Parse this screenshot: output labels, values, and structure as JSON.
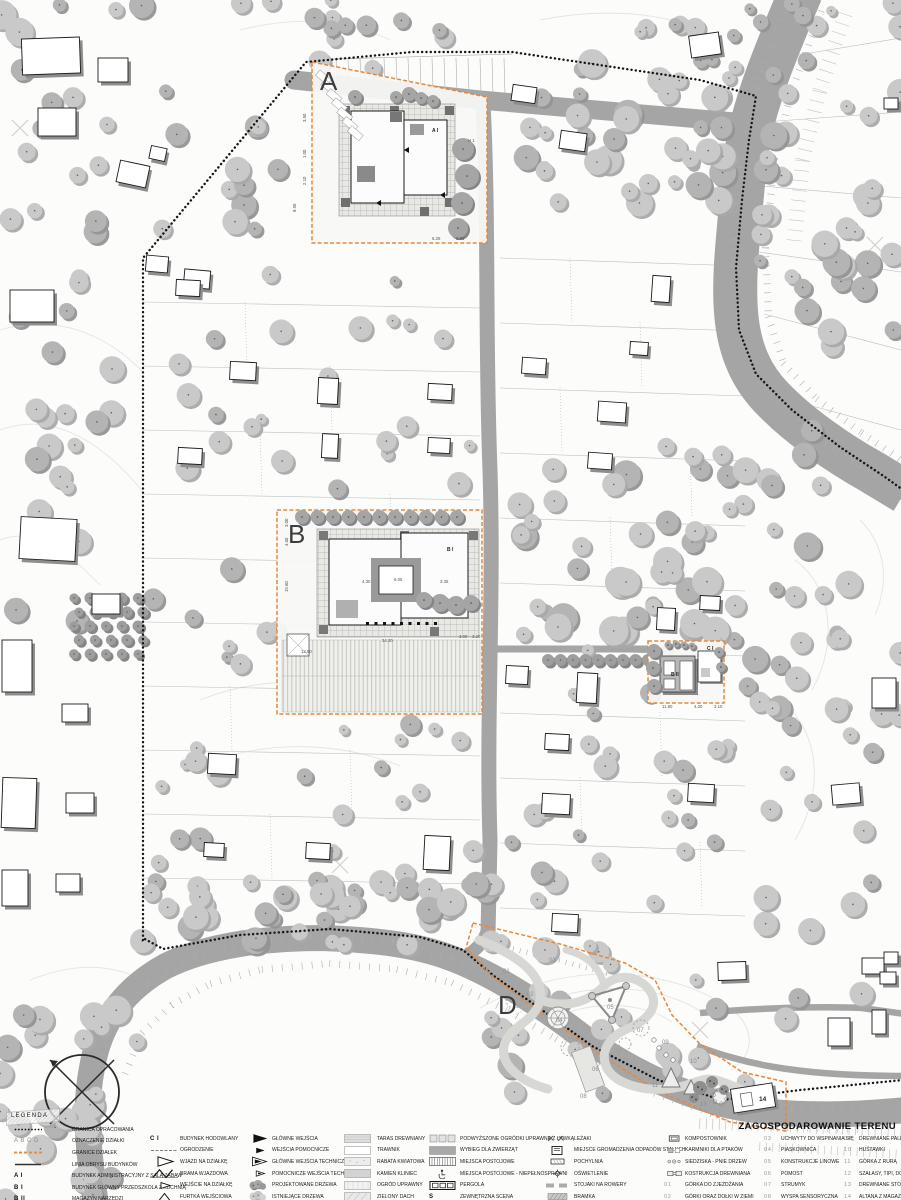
{
  "legend": {
    "title": "ZAGOSPODAROWANIE TERENU",
    "heading": "LEGENDA",
    "columns": [
      {
        "items": [
          {
            "sym": "dots",
            "label": "GRANICA OPRACOWANIA"
          },
          {
            "sym": "key-gray",
            "key": "A B C D",
            "label": "OZNACZENIE DZIAŁKI"
          },
          {
            "sym": "orange-dash",
            "label": "GRANICE DZIAŁEK"
          },
          {
            "sym": "solid-line",
            "label": "LINIA OBRYSU BUDYNKÓW"
          },
          {
            "sym": "key",
            "key": "A I",
            "label": "BUDYNEK ADMINISTRACYJNY Z SALĄ ZABAW"
          },
          {
            "sym": "key",
            "key": "B I",
            "label": "BUDYNEK GŁÓWNY PRZEDSZKOLA Z KUCHNIĄ"
          },
          {
            "sym": "key",
            "key": "B II",
            "label": "MAGAZYN NARZĘDZI"
          }
        ]
      },
      {
        "items": [
          {
            "sym": "key",
            "key": "C I",
            "label": "BUDYNEK HODOWLANY"
          },
          {
            "sym": "fence",
            "label": "OGRODZENIE"
          },
          {
            "sym": "tri-open-lg",
            "label": "WJAZD NA DZIAŁKĘ"
          },
          {
            "sym": "gate",
            "label": "BRAMA WJAZDOWA"
          },
          {
            "sym": "tri-open-sm",
            "label": "WEJŚCIE NA DZIAŁKĘ"
          },
          {
            "sym": "wicket",
            "label": "FURTKA WEJŚCIOWA"
          }
        ]
      },
      {
        "items": [
          {
            "sym": "tri-fill-lg",
            "label": "GŁÓWNE WEJŚCIA"
          },
          {
            "sym": "tri-fill-sm",
            "label": "WEJŚCIA POMOCNICZE"
          },
          {
            "sym": "tri-tech-lg",
            "label": "GŁÓWNE WEJŚCIA TECHNICZNE"
          },
          {
            "sym": "tri-tech-sm",
            "label": "POMOCNICZE WEJŚCIA TECHNICZNE"
          },
          {
            "sym": "tree-dark",
            "label": "PROJEKTOWANE DRZEWA"
          },
          {
            "sym": "tree-light",
            "label": "ISTNIEJĄCE DRZEWA"
          }
        ]
      },
      {
        "items": [
          {
            "sym": "sw-taras",
            "label": "TARAS DREWNIANY"
          },
          {
            "sym": "sw-trawnik",
            "label": "TRAWNIK"
          },
          {
            "sym": "sw-rabata",
            "label": "RABATA KWIATOWA"
          },
          {
            "sym": "sw-kamien",
            "label": "KAMIEŃ KLINIEC"
          },
          {
            "sym": "sw-ogrod",
            "label": "OGRÓD UPRAWNY"
          },
          {
            "sym": "sw-dach",
            "label": "ZIELONY DACH"
          }
        ]
      },
      {
        "items": [
          {
            "sym": "boxes3",
            "label": "PODWYŻSZONE OGRÓDKI UPRAWNE Z ŁAWKĄ"
          },
          {
            "sym": "sw-wybieg",
            "label": "WYBIEG DLA ZWIERZĄT"
          },
          {
            "sym": "stripes",
            "label": "MIEJSCA POSTOJOWE"
          },
          {
            "sym": "disabled",
            "label": "MIEJSCA POSTOJOWE - NIEPEŁNOSPRAWNI"
          },
          {
            "sym": "pergola",
            "label": "PERGOLA"
          },
          {
            "sym": "key",
            "key": "S",
            "label": "ZEWNĘTRZNA SCENA"
          }
        ]
      },
      {
        "items": [
          {
            "sym": "lezaki",
            "label": "LEŻAKI"
          },
          {
            "sym": "odpady",
            "label": "MIEJSCE GROMADZENIA ODPADÓW STAŁYCH"
          },
          {
            "sym": "pochylnia",
            "label": "POCHYLNIA"
          },
          {
            "sym": "oswietlenie",
            "label": "OŚWIETLENIE"
          },
          {
            "sym": "stojaki",
            "label": "STOJAKI NA ROWERY"
          },
          {
            "sym": "bramka",
            "label": "BRAMKA"
          }
        ]
      },
      {
        "items": [
          {
            "sym": "kompost",
            "label": "KOMPOSTOWNIK"
          },
          {
            "sym": "karmniki",
            "label": "KARMNIKI DLA PTAKÓW"
          },
          {
            "sym": "siedziska",
            "label": "SIEDZISKA - PNIE DRZEW"
          },
          {
            "sym": "konstrukcja",
            "label": "KOSTRUKCJA DREWNIANA"
          },
          {
            "sym": "key-num",
            "key": "01",
            "label": "GÓRKA DO ZJEŻDŻANIA"
          },
          {
            "sym": "key-num",
            "key": "02",
            "label": "GÓRKI ORAZ DOŁKI W ZIEMI"
          }
        ]
      },
      {
        "items": [
          {
            "sym": "key-num",
            "key": "03",
            "label": "UCHWYTY DO WSPINANIA SIĘ"
          },
          {
            "sym": "key-num",
            "key": "04",
            "label": "PIASKOWNICA"
          },
          {
            "sym": "key-num",
            "key": "05",
            "label": "KONSTRUKCJE LINOWE"
          },
          {
            "sym": "key-num",
            "key": "06",
            "label": "POMOST"
          },
          {
            "sym": "key-num",
            "key": "07",
            "label": "STRUMYK"
          },
          {
            "sym": "key-num",
            "key": "08",
            "label": "WYSPA SENSORYCZNA"
          }
        ]
      },
      {
        "items": [
          {
            "sym": "key-num",
            "key": "09",
            "label": "DREWNIANE PALE"
          },
          {
            "sym": "key-num",
            "key": "10",
            "label": "HUŚTAWKI"
          },
          {
            "sym": "key-num",
            "key": "11",
            "label": "GÓRKA Z RURĄ"
          },
          {
            "sym": "key-num",
            "key": "12",
            "label": "SZAŁASY, TIPI, DOMKI"
          },
          {
            "sym": "key-num",
            "key": "13",
            "label": "DREWNIANE STOŁECZKI"
          },
          {
            "sym": "key-num",
            "key": "14",
            "label": "ALTANA Z MAGAZYNEM"
          }
        ]
      }
    ]
  },
  "map": {
    "area_labels": [
      {
        "t": "A",
        "x": 320,
        "y": 90
      },
      {
        "t": "B",
        "x": 288,
        "y": 543
      },
      {
        "t": "D",
        "x": 498,
        "y": 1014
      }
    ],
    "building_labels": [
      {
        "t": "A I",
        "x": 432,
        "y": 132
      },
      {
        "t": "B I",
        "x": 447,
        "y": 551
      },
      {
        "t": "C I",
        "x": 707,
        "y": 650
      },
      {
        "t": "B II",
        "x": 671,
        "y": 676
      },
      {
        "t": "14",
        "x": 759,
        "y": 1101
      }
    ],
    "dimensions": [
      {
        "t": "8.90",
        "x": 296,
        "y": 212,
        "r": -90
      },
      {
        "t": "3.50",
        "x": 306,
        "y": 122,
        "r": -90
      },
      {
        "t": "1.00",
        "x": 306,
        "y": 158,
        "r": -90
      },
      {
        "t": "2.10",
        "x": 306,
        "y": 185,
        "r": -90
      },
      {
        "t": "6.25",
        "x": 432,
        "y": 240,
        "r": 0
      },
      {
        "t": "5.00",
        "x": 456,
        "y": 240,
        "r": 0
      },
      {
        "t": "H 1",
        "x": 468,
        "y": 142,
        "r": 0
      },
      {
        "t": "4.60",
        "x": 288,
        "y": 546,
        "r": -90
      },
      {
        "t": "3.00",
        "x": 288,
        "y": 527,
        "r": -90
      },
      {
        "t": "19.60",
        "x": 288,
        "y": 592,
        "r": -90
      },
      {
        "t": "4.30",
        "x": 362,
        "y": 583,
        "r": 0
      },
      {
        "t": "6.05",
        "x": 394,
        "y": 581,
        "r": 0
      },
      {
        "t": "3.35",
        "x": 440,
        "y": 583,
        "r": 0
      },
      {
        "t": "34.30",
        "x": 382,
        "y": 642,
        "r": 0
      },
      {
        "t": "12.50",
        "x": 301,
        "y": 653,
        "r": 0
      },
      {
        "t": "3.00",
        "x": 459,
        "y": 638,
        "r": 0
      },
      {
        "t": "3.20",
        "x": 472,
        "y": 638,
        "r": 0
      },
      {
        "t": "11.80",
        "x": 662,
        "y": 708,
        "r": 0
      },
      {
        "t": "4.20",
        "x": 694,
        "y": 708,
        "r": 0
      },
      {
        "t": "3.10",
        "x": 714,
        "y": 708,
        "r": 0
      }
    ],
    "playground_numbers": [
      {
        "n": "01",
        "x": 503,
        "y": 973
      },
      {
        "n": "02",
        "x": 527,
        "y": 996
      },
      {
        "n": "03",
        "x": 549,
        "y": 962
      },
      {
        "n": "04",
        "x": 556,
        "y": 1022
      },
      {
        "n": "05",
        "x": 607,
        "y": 1009
      },
      {
        "n": "06",
        "x": 592,
        "y": 1071
      },
      {
        "n": "07",
        "x": 637,
        "y": 1032
      },
      {
        "n": "08",
        "x": 580,
        "y": 1098
      },
      {
        "n": "09",
        "x": 662,
        "y": 1044
      },
      {
        "n": "10",
        "x": 690,
        "y": 1063
      },
      {
        "n": "11",
        "x": 652,
        "y": 1087
      },
      {
        "n": "12",
        "x": 718,
        "y": 1092
      },
      {
        "n": "13",
        "x": 700,
        "y": 1106
      }
    ]
  }
}
